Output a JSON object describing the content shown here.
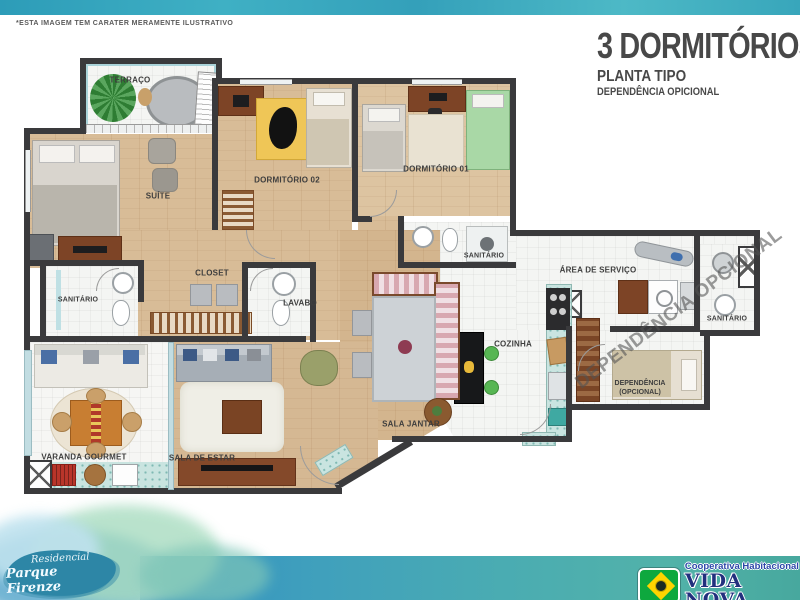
{
  "disclaimer": "*ESTA IMAGEM TEM CARATER MERAMENTE ILUSTRATIVO",
  "title_block": {
    "title": "3 DORMITÓRIOS",
    "subtitle": "PLANTA TIPO",
    "option_line": "DEPENDÊNCIA OPICIONAL"
  },
  "rooms": {
    "terraco": "TERRAÇO",
    "suite": "SUÍTE",
    "dormitorio_02": "DORMITÓRIO 02",
    "dormitorio_01": "DORMITÓRIO 01",
    "sanitario_suite": "SANITÁRIO",
    "closet": "CLOSET",
    "lavabo": "LAVABO",
    "sanitario_dormitorios": "SANITÁRIO",
    "area_servico": "ÁREA DE SERVIÇO",
    "sanitario_dependencia": "SANITÁRIO",
    "cozinha": "COZINHA",
    "dependencia_linha1": "DEPENDÊNCIA",
    "dependencia_linha2": "(OPCIONAL)",
    "sala_jantar": "SALA JANTAR",
    "sala_estar": "SALA DE ESTAR",
    "varanda_gourmet": "VARANDA GOURMET"
  },
  "watermark": "DEPENDÊNCIA OPCIONAL",
  "branding": {
    "residencial": "Residencial",
    "empreendimento": "Parque Firenze",
    "cooperativa": "Cooperativa Habitacional",
    "cooperativa_nome": "VIDA NOVA"
  },
  "colors": {
    "wall": "#3a3a3c",
    "wood_floor": "#d8bc97",
    "tile_floor": "#f4f5f3",
    "teal_tile": "#c9e4e0",
    "band_teal": "#3fa9b8",
    "flag_green": "#0ea83e",
    "flag_yellow": "#ffd400",
    "logo_blue": "#22307e"
  }
}
